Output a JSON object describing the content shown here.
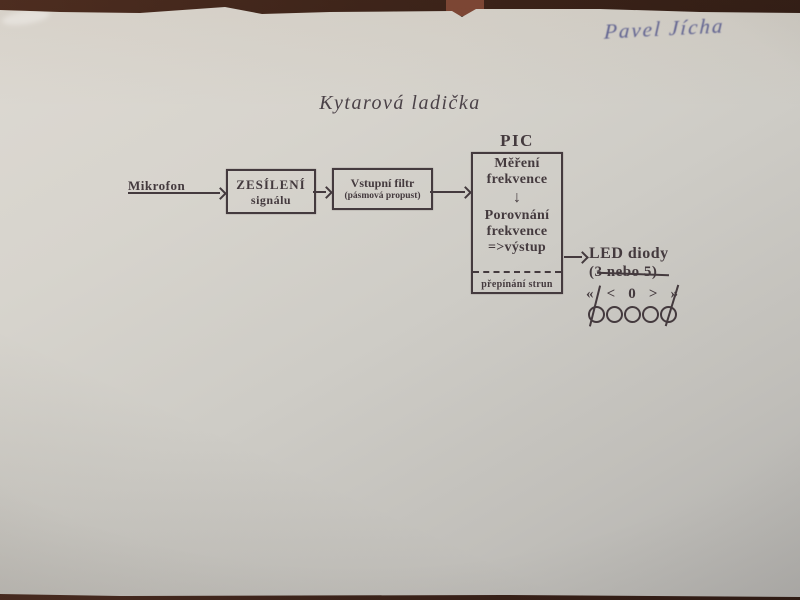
{
  "page": {
    "handwritten_name": "Pavel Jícha",
    "title": "Kytarová ladička"
  },
  "diagram": {
    "input_label": "Mikrofon",
    "amplifier": {
      "line1": "ZESÍLENÍ",
      "line2": "signálu"
    },
    "filter": {
      "line1": "Vstupní filtr",
      "line2": "(pásmová propust)"
    },
    "pic": {
      "label": "PIC",
      "step1_line1": "Měření",
      "step1_line2": "frekvence",
      "down_arrow": "↓",
      "step2_line1": "Porovnání",
      "step2_line2": "frekvence",
      "step2_line3": "=>výstup",
      "footer": "přepínání strun"
    },
    "output": {
      "line1": "LED diody",
      "line2": "(3 nebo 5)"
    },
    "indicator_symbols": [
      "«",
      "<",
      "0",
      ">",
      "»"
    ],
    "led_count": 5
  },
  "colors": {
    "ink": "#443a3e",
    "pen_ink": "#5e6294",
    "paper_light": "#dbd8d1",
    "paper_dark": "#b2b1ae",
    "table": "#3a2118"
  }
}
